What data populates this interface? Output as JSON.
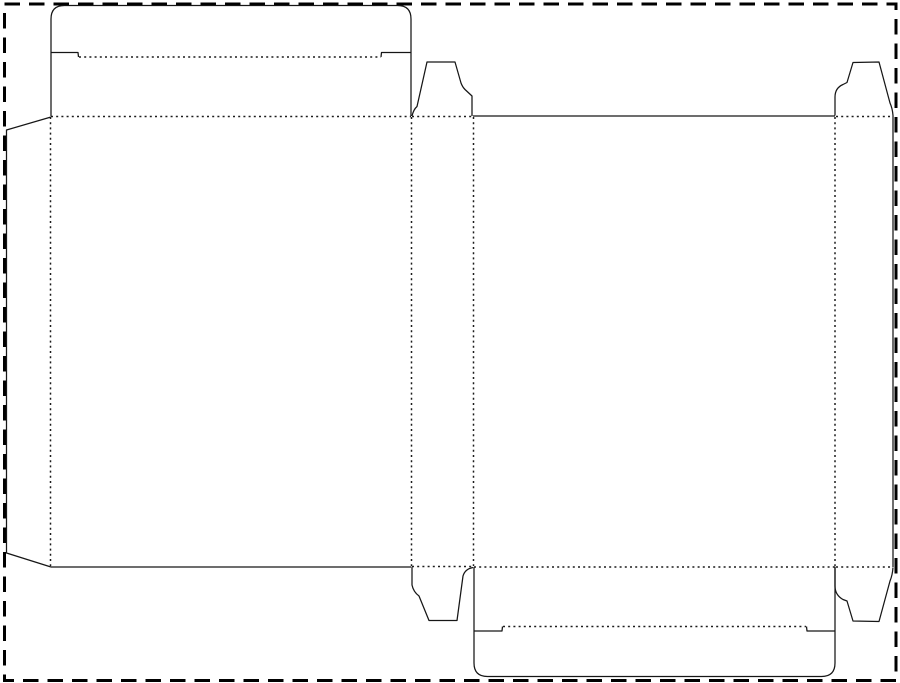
{
  "meta": {
    "description": "Blank folding-carton dieline (reverse tuck end box): solid cut lines, dotted fold lines, dashed sheet boundary",
    "canvas": {
      "width": 900,
      "height": 683,
      "background_color": "#ffffff"
    },
    "line_styles": {
      "cut": {
        "color": "#161616",
        "stroke_width": 1.25,
        "dash": null
      },
      "fold": {
        "color": "#1c1c1c",
        "stroke_width": 1.5,
        "dash": "2 3.2"
      },
      "sheet": {
        "color": "#000000",
        "stroke_width": 3,
        "dash": "15.5 9"
      }
    }
  },
  "dieline": {
    "sheet_border": {
      "x": 4.5,
      "y": 4,
      "width": 891.5,
      "height": 676.5
    },
    "cut_paths": [
      {
        "name": "glue-flap-outline",
        "d": "M 51 117 L 6.5 130 L 6.5 553 L 51 567"
      },
      {
        "name": "top-tuck-flap-outline",
        "d": "M 51 116 L 51 19 Q 51 5.5 64.5 5.5 L 397.5 5.5 Q 411 5.5 411 19 L 411 116"
      },
      {
        "name": "top-tuck-notch-left",
        "d": "M 51 52.5 L 78 52.5 L 78.5 57"
      },
      {
        "name": "top-tuck-notch-right",
        "d": "M 411 52.5 L 381.5 52.5 L 381 57"
      },
      {
        "name": "front-panel-bottom-edge",
        "d": "M 51 567 L 411 567"
      },
      {
        "name": "back-panel-top-edge",
        "d": "M 473 116 L 835 116"
      },
      {
        "name": "right-side-panel-outer-edge",
        "d": "M 893 115.5 L 893 567"
      },
      {
        "name": "left-dust-flap-top",
        "d": "M 412 116 Q 413.5 109.5 417 106.5 L 427 62 L 455 62 L 461 83 Q 462.5 87 465 89.5 L 472 96 L 472 116"
      },
      {
        "name": "right-dust-flap-top",
        "d": "M 835 115.5 L 835 97 Q 835 88 843 84.5 L 847 82.5 L 853 62.5 L 879 62 L 890 103 Q 892.5 108.5 893 115.5"
      },
      {
        "name": "left-dust-flap-bottom",
        "d": "M 412 567 L 412 585 Q 413.5 592 419 596 L 429 620.5 L 457 620.5 L 463 576 Q 465 569 473 567.5"
      },
      {
        "name": "right-dust-flap-bottom",
        "d": "M 835 567.5 L 835 586 Q 835 595 843 599.5 L 847 601 L 853 621 L 879 621.5 L 890 581 Q 892.5 575 893 567.5"
      },
      {
        "name": "bottom-tuck-flap-outline",
        "d": "M 474 567 L 474 663 Q 474 676.5 487.5 676.5 L 821.5 676.5 Q 835 676.5 835 663 L 835 567"
      },
      {
        "name": "bottom-tuck-notch-left",
        "d": "M 474 631 L 502 631 L 502.5 626.5"
      },
      {
        "name": "bottom-tuck-notch-right",
        "d": "M 835 631 L 807 631 L 806.5 626.5"
      }
    ],
    "fold_lines": [
      {
        "name": "glue-flap-fold",
        "x1": 50.5,
        "y1": 117,
        "x2": 50.5,
        "y2": 566
      },
      {
        "name": "front-panel-top-fold",
        "x1": 51,
        "y1": 116.5,
        "x2": 411,
        "y2": 116.5
      },
      {
        "name": "top-tuck-fold",
        "x1": 79,
        "y1": 57,
        "x2": 381,
        "y2": 57
      },
      {
        "name": "left-dust-flap-top-fold",
        "x1": 412,
        "y1": 116.5,
        "x2": 472,
        "y2": 116.5
      },
      {
        "name": "left-side-panel-left-fold",
        "x1": 411.5,
        "y1": 117,
        "x2": 411.5,
        "y2": 566.5
      },
      {
        "name": "left-side-panel-right-fold",
        "x1": 473.5,
        "y1": 117,
        "x2": 473.5,
        "y2": 566
      },
      {
        "name": "left-dust-flap-bottom-fold",
        "x1": 412,
        "y1": 566.5,
        "x2": 473,
        "y2": 566.5
      },
      {
        "name": "back-panel-right-fold",
        "x1": 835,
        "y1": 117,
        "x2": 835,
        "y2": 566.5
      },
      {
        "name": "right-dust-flap-top-fold",
        "x1": 836,
        "y1": 116.5,
        "x2": 891,
        "y2": 116.5
      },
      {
        "name": "back-panel-bottom-fold",
        "x1": 474,
        "y1": 567,
        "x2": 835,
        "y2": 567
      },
      {
        "name": "right-dust-flap-bottom-fold",
        "x1": 836,
        "y1": 567,
        "x2": 891,
        "y2": 567
      },
      {
        "name": "bottom-tuck-fold",
        "x1": 503,
        "y1": 626.5,
        "x2": 806,
        "y2": 626.5
      }
    ]
  }
}
